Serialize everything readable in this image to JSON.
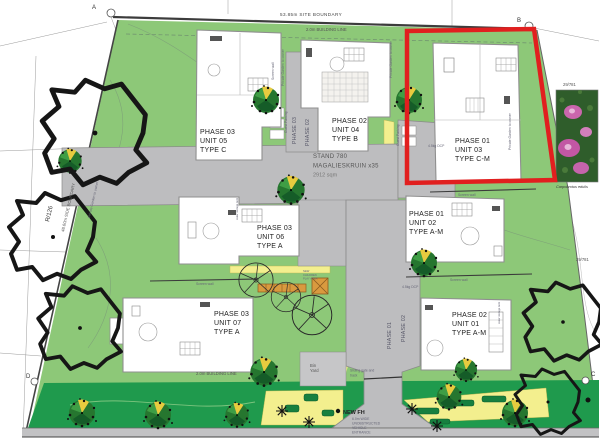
{
  "site": {
    "boundary_top_label": "53.85m SITE BOUNDARY",
    "building_line_label": "2.0m BUILDING LINE",
    "building_line_bottom_label": "2.0m BUILDING LINE",
    "side_boundary_label": "48.60m SIDE BOUNDARY",
    "erf_ref": "R/126",
    "neighbor_ref": "29/781",
    "stand_line1": "STAND 780",
    "stand_line2": "MAGALIESKRUIN x35",
    "stand_line3": "2912 sqm",
    "marker_a": "A",
    "marker_b": "B",
    "marker_c": "C",
    "marker_d": "D"
  },
  "units": [
    {
      "phase": "PHASE 03",
      "unit": "UNIT 05",
      "type": "TYPE C"
    },
    {
      "phase": "PHASE 02",
      "unit": "UNIT 04",
      "type": "TYPE B"
    },
    {
      "phase": "PHASE 01",
      "unit": "UNIT 03",
      "type": "TYPE C-M"
    },
    {
      "phase": "PHASE 03",
      "unit": "UNIT 06",
      "type": "TYPE A"
    },
    {
      "phase": "PHASE 01",
      "unit": "UNIT 02",
      "type": "TYPE A-M"
    },
    {
      "phase": "PHASE 03",
      "unit": "UNIT 07",
      "type": "TYPE A"
    },
    {
      "phase": "PHASE 02",
      "unit": "UNIT 01",
      "type": "TYPE A-M"
    }
  ],
  "roads": {
    "upper_label_1": "PHASE 03",
    "upper_label_2": "PHASE 02",
    "lower_label_1": "PHASE 01",
    "lower_label_2": "PHASE 02"
  },
  "annotations": {
    "screen_wall": "Screen wall",
    "private_garden": "Private Garden to owner",
    "guest_parking": "Guest Parking",
    "water_tank": "water storage tank",
    "dcp": "4.5kg DCP",
    "bin_line1": "Bin",
    "bin_line2": "Yard",
    "gate_line1": "Sliding gate and",
    "gate_line2": "track",
    "new_fh": "NEW FH",
    "entrance_line1": "6.0m WIDE",
    "entrance_line2": "UNOBSTRUCTED",
    "entrance_line3": "VEHICLE",
    "entrance_line4": "ENTRANCE",
    "play_line1": "NEW",
    "play_line2": "CHILDREN",
    "play_line3": "PLAY AREA"
  },
  "plant_photo": {
    "caption": "Carpobrotus edulis"
  },
  "colors": {
    "site_green": "#8dc878",
    "dark_green": "#1f9a4d",
    "bed_yellow": "#f3ef8e",
    "road_gray": "#bdbdbf",
    "highlight_red": "#e11f1f"
  }
}
